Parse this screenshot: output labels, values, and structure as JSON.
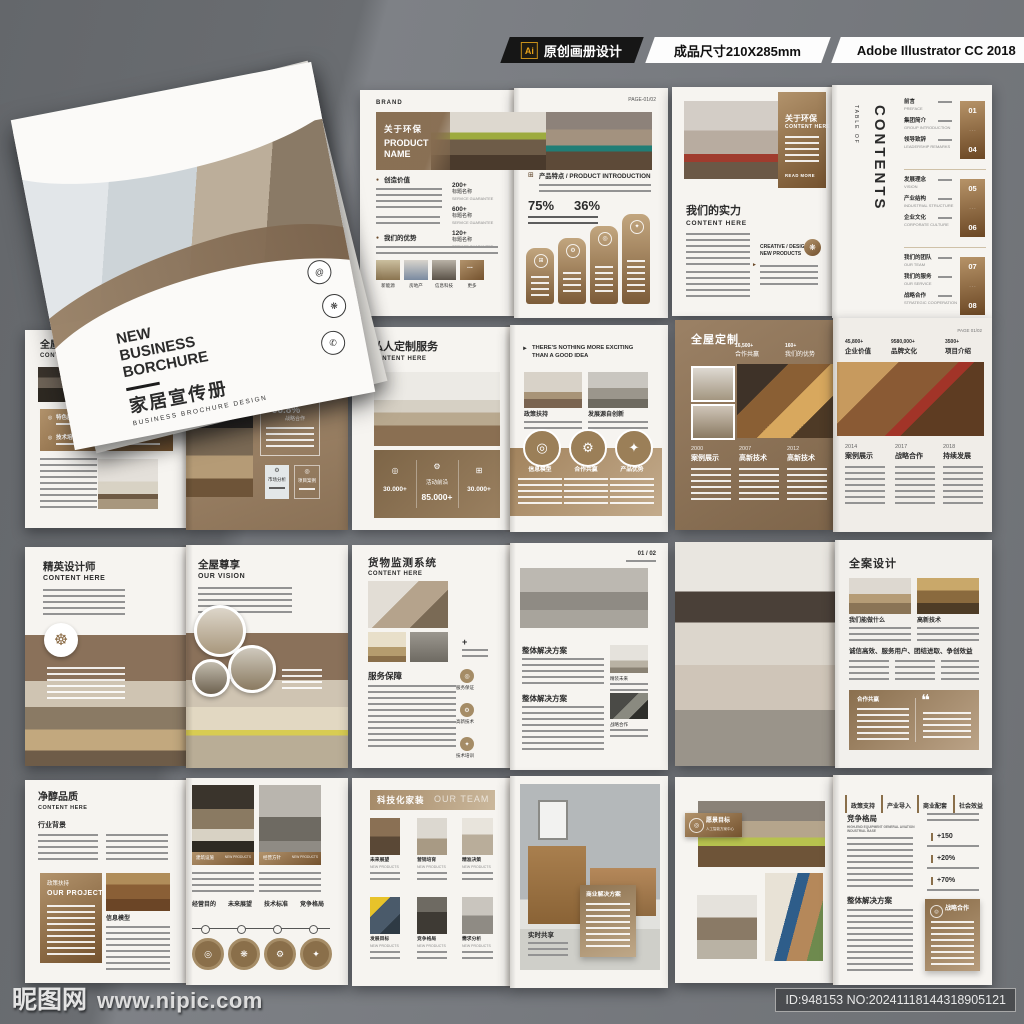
{
  "header": {
    "ai_badge": "Ai",
    "design_label": "原创画册设计",
    "size_label": "成品尺寸210X285mm",
    "software_label": "Adobe Illustrator CC 2018"
  },
  "watermark": {
    "site_name": "昵图网",
    "site_url": "www.nipic.com",
    "image_id": "ID:948153 NO:20241118144318905121"
  },
  "icons": {
    "hexagon": "⬡",
    "at": "@",
    "flower": "❋",
    "phone": "✆",
    "target": "◎",
    "gear": "⚙",
    "wheel": "☸",
    "play": "►",
    "quote": "❝",
    "dot": "●",
    "plus": "+",
    "grid": "⊞",
    "star": "✦"
  },
  "cover": {
    "brand": "BRAND",
    "brand_sub": "BUSINESS BROCHURE",
    "title_line1": "NEW",
    "title_line2": "BUSINESS",
    "title_line3": "BORCHURE",
    "title_cn": "家居宣传册",
    "subtitle": "BUSINESS BROCHURE DESIGN"
  },
  "spread_product": {
    "brand": "BRAND",
    "page": "PAGE-01/02",
    "banner_cn": "关于环保",
    "banner_en": "PRODUCT NAME",
    "section1": "创造价值",
    "section2": "我们的优势",
    "stats": [
      {
        "value": "200+",
        "label": "标题名称",
        "sub": "SERVICE GUARANTEE"
      },
      {
        "value": "600+",
        "label": "标题名称",
        "sub": "SERVICE GUARANTEE"
      },
      {
        "value": "120+",
        "label": "标题名称",
        "sub": "SERVICE GUARANTEE"
      }
    ],
    "thumbs": [
      "新能源",
      "房地产",
      "信息科技",
      "更多"
    ],
    "more_dots": "...",
    "right_title": "产品特点 / PRODUCT INTRODUCTION",
    "percent1": "75%",
    "percent2": "36%"
  },
  "spread_about": {
    "panel_cn": "关于环保",
    "panel_en": "CONTENT HERE",
    "read_more": "READ MORE",
    "strength_cn": "我们的实力",
    "strength_en": "CONTENT HERE",
    "creative": "CREATIVE / DESIGN",
    "new_products": "NEW PRODUCTS",
    "toc_top": "TABLE OF",
    "toc_main": "CONTENTS",
    "groups": [
      {
        "i1cn": "前言",
        "i1en": "PREFACE",
        "i2cn": "集团简介",
        "i2en": "GROUP INTRODUCTION",
        "i3cn": "领导致辞",
        "i3en": "LEADERSHIP REMARKS",
        "from": "01",
        "to": "04"
      },
      {
        "i1cn": "发展理念",
        "i1en": "VISION",
        "i2cn": "产业结构",
        "i2en": "INDUSTRIAL STRUCTURE",
        "i3cn": "企业文化",
        "i3en": "CORPORATE CULTURE",
        "from": "05",
        "to": "06"
      },
      {
        "i1cn": "我们的团队",
        "i1en": "OUR TEAM",
        "i2cn": "我们的服务",
        "i2en": "OUR SERVICE",
        "i3cn": "战略合作",
        "i3en": "STRATEGIC COOPERATION",
        "from": "07",
        "to": "08"
      }
    ]
  },
  "spread_custom": {
    "title_cn": "全屋定制",
    "title_en": "CONTENT HERE",
    "section": "体系施工",
    "tag1": "特色服务",
    "tag2": "需求分析",
    "tag3": "技术培训",
    "tag4": "市场分析",
    "stat_value": "+96.8%",
    "stat_label": "战略合作",
    "card1": "市场分析",
    "card2": "项目案例"
  },
  "spread_private": {
    "title_cn": "私人定制服务",
    "title_en": "CONTENT HERE",
    "slogan1": "THERE'S NOTHING MORE EXCITING",
    "slogan2": "THAN A GOOD IDEA",
    "cap1": "政策扶持",
    "cap2": "发展源自创新",
    "stat1": "30.000+",
    "stat2_label": "活动前沿",
    "stat2": "85.000+",
    "stat3": "30.000+",
    "circle1": "信息模型",
    "circle2": "合作共赢",
    "circle3": "产品优势"
  },
  "spread_timeline": {
    "title": "全屋定制",
    "page": "PAGE 01/02",
    "ls1v": "16,500+",
    "ls1l": "合作共赢",
    "ls2v": "160+",
    "ls2l": "我们的优势",
    "rs1v": "45,800+",
    "rs1l": "企业价值",
    "rs2v": "9580,000+",
    "rs2l": "品牌文化",
    "rs3v": "3500+",
    "rs3l": "项目介绍",
    "m1y": "2000",
    "m1l": "案例展示",
    "m2y": "2007",
    "m2l": "高新技术",
    "m3y": "2012",
    "m3l": "高新技术",
    "m4y": "2014",
    "m4l": "案例展示",
    "m5y": "2017",
    "m5l": "战略合作",
    "m6y": "2018",
    "m6l": "持续发展"
  },
  "spread_designer": {
    "left_cn": "精英设计师",
    "left_en": "CONTENT HERE",
    "right_cn": "全屋尊享",
    "right_en": "OUR VISION"
  },
  "spread_monitor": {
    "title_cn": "货物监测系统",
    "title_en": "CONTENT HERE",
    "page": "01 / 02",
    "section": "服务保障",
    "b1": "服务保证",
    "b2": "高新技术",
    "b3": "技术培训",
    "sec1": "整体解决方案",
    "cap1": "精装未来",
    "sec2": "整体解决方案",
    "cap2": "战略合作"
  },
  "spread_design": {
    "title": "全案设计",
    "cap1": "我们能做什么",
    "cap2": "高新技术",
    "slogan": "诚信高效、服务用户、团结进取、争创效益",
    "box_label": "合作共赢"
  },
  "spread_quality": {
    "title_cn": "净醇品质",
    "title_en": "CONTENT HERE",
    "section": "行业背景",
    "project_cn": "政策扶持",
    "project_en": "OUR PROJECT",
    "caption": "信息模型",
    "p1cn": "建筑设施",
    "p1en": "NEW PRODUCTS",
    "p2cn": "经营方针",
    "p2en": "NEW PRODUCTS",
    "t1": "经营目的",
    "t2": "未来展望",
    "t3": "技术标准",
    "t4": "竞争格局"
  },
  "spread_tech": {
    "banner_cn": "科技化家装",
    "banner_en": "OUR TEAM",
    "c1": "未来展望",
    "c2": "营销培育",
    "c3": "精准决策",
    "c4": "发展目标",
    "c5": "竞争格局",
    "c6": "需求分析",
    "sub": "NEW PRODUCTS",
    "box": "商业解决方案",
    "caption": "实时共享"
  },
  "spread_vision": {
    "badge": "愿景目标",
    "badge_sub": "人工智能方案中心",
    "tab1": "政策支持",
    "tab2": "产业导入",
    "tab3": "商业配套",
    "tab4": "社会效益",
    "sec1": "竞争格局",
    "sec1_sub": "HIGH-END EQUIPMENT GENERAL AVIATION INDUSTRIAL BASE",
    "s1": "+150",
    "s2": "+20%",
    "s3": "+70%",
    "sec2": "整体解决方案",
    "box": "战略合作"
  },
  "colors": {
    "accent_brown": "#8a6a44",
    "page": "#f6f4f0",
    "background_gray": "#6e7175"
  }
}
